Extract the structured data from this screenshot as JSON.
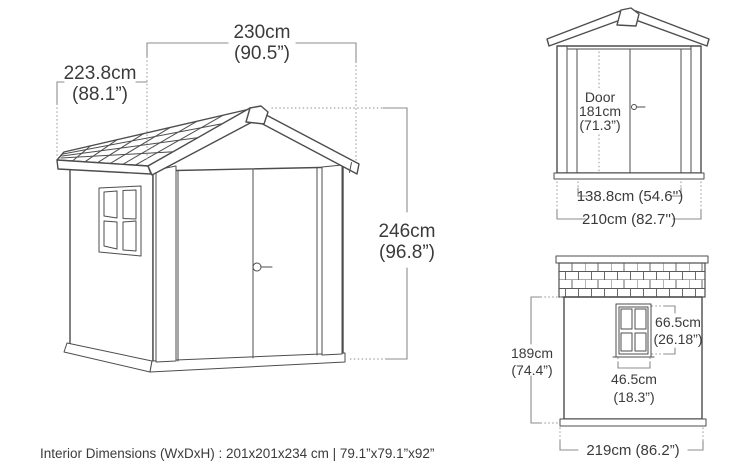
{
  "main_view": {
    "width_cm": "230cm",
    "width_in": "(90.5”)",
    "depth_cm": "223.8cm",
    "depth_in": "(88.1”)",
    "height_cm": "246cm",
    "height_in": "(96.8”)"
  },
  "front_view": {
    "door_label": "Door",
    "door_height_cm": "181cm",
    "door_height_in": "(71.3”)",
    "door_width": "138.8cm (54.6'')",
    "overall_width": "210cm (82.7'')"
  },
  "side_view": {
    "wall_height_cm": "189cm",
    "wall_height_in": "(74.4”)",
    "window_height_cm": "66.5cm",
    "window_height_in": "(26.18”)",
    "window_width_cm": "46.5cm",
    "window_width_in": "(18.3”)",
    "overall_width": "219cm (86.2”)"
  },
  "footer": {
    "interior_dimensions": "Interior Dimensions (WxDxH) : 201x201x234 cm | 79.1”x79.1”x92”"
  },
  "colors": {
    "drawing_line": "#4d4d4d",
    "dimension_line": "#8c8c8c",
    "dotted_line": "#a2a2a2",
    "text": "#3b3b3b",
    "background": "#ffffff"
  }
}
